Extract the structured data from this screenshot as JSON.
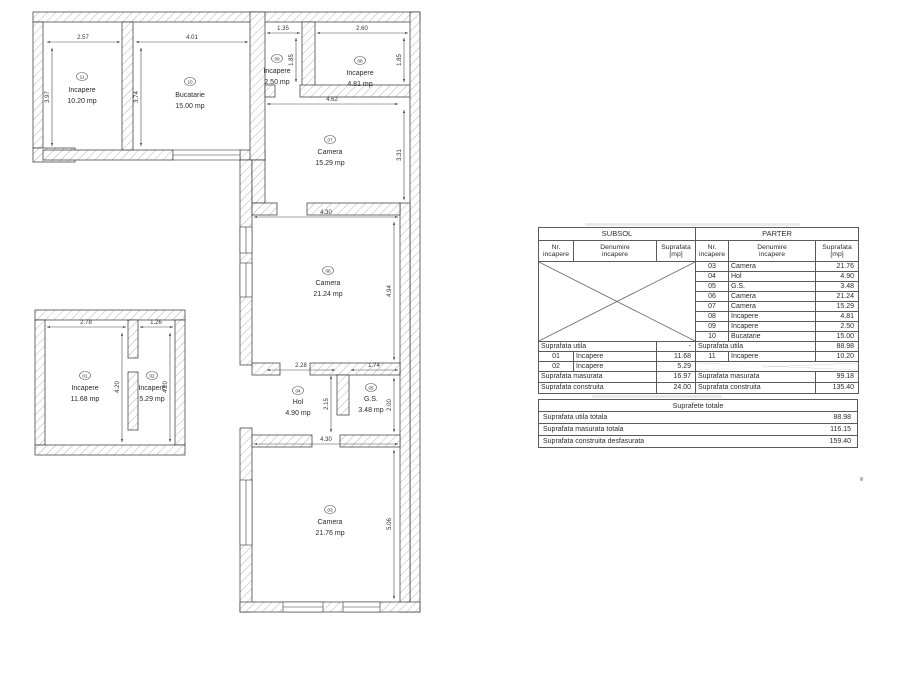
{
  "parter": {
    "rooms": [
      {
        "num": "11",
        "name": "Incapere",
        "area": "10.20 mp"
      },
      {
        "num": "10",
        "name": "Bucatarie",
        "area": "15.00 mp"
      },
      {
        "num": "09",
        "name": "Incapere",
        "area": "2.50 mp"
      },
      {
        "num": "08",
        "name": "Incapere",
        "area": "4.81 mp"
      },
      {
        "num": "07",
        "name": "Camera",
        "area": "15.29 mp"
      },
      {
        "num": "06",
        "name": "Camera",
        "area": "21.24 mp"
      },
      {
        "num": "04",
        "name": "Hol",
        "area": "4.90 mp"
      },
      {
        "num": "05",
        "name": "G.S.",
        "area": "3.48 mp"
      },
      {
        "num": "03",
        "name": "Camera",
        "area": "21.76 mp"
      }
    ],
    "dims": {
      "r11w": "2.57",
      "r11h": "3.97",
      "r10w": "4.01",
      "r10h": "3.74",
      "r09w": "1.35",
      "r09h": "1.85",
      "r08w": "2.60",
      "r08h": "1.85",
      "r07w": "4.62",
      "r07h": "3.31",
      "r06w": "4.30",
      "r06h": "4.94",
      "r04w": "2.28",
      "r04h": "2.15",
      "r05w": "1.74",
      "r05h": "2.00",
      "r03w": "4.30",
      "r03h": "5.06"
    }
  },
  "subsol": {
    "rooms": [
      {
        "num": "01",
        "name": "Incapere",
        "area": "11.68 mp"
      },
      {
        "num": "02",
        "name": "Incapere",
        "area": "5.29 mp"
      }
    ],
    "dims": {
      "r01w": "2.78",
      "r01h": "4.20",
      "r02w": "1.26",
      "r02h": "4.20"
    }
  },
  "tables": {
    "cols": {
      "nr_l1": "Nr.",
      "nr_l2": "incapere",
      "den_l1": "Denumire",
      "den_l2": "incapere",
      "sup_l1": "Suprafata",
      "sup_l2": "[mp]"
    },
    "subsol": {
      "title": "SUBSOL",
      "utila_label": "Suprafata utila",
      "utila_value": "-",
      "rows": [
        {
          "nr": "01",
          "name": "Incapere",
          "area": "11.68"
        },
        {
          "nr": "02",
          "name": "Incapere",
          "area": "5.29"
        }
      ],
      "masurata_label": "Suprafata masurata",
      "masurata_value": "16.97",
      "construita_label": "Suprafata construita",
      "construita_value": "24.00"
    },
    "parter": {
      "title": "PARTER",
      "rows": [
        {
          "nr": "03",
          "name": "Camera",
          "area": "21.76"
        },
        {
          "nr": "04",
          "name": "Hol",
          "area": "4.90"
        },
        {
          "nr": "05",
          "name": "G.S.",
          "area": "3.48"
        },
        {
          "nr": "06",
          "name": "Camera",
          "area": "21.24"
        },
        {
          "nr": "07",
          "name": "Camera",
          "area": "15.29"
        },
        {
          "nr": "08",
          "name": "Incapere",
          "area": "4.81"
        },
        {
          "nr": "09",
          "name": "Incapere",
          "area": "2.50"
        },
        {
          "nr": "10",
          "name": "Bucatarie",
          "area": "15.00"
        }
      ],
      "utila_label": "Suprafata utila",
      "utila_value": "88.98",
      "extra_row": {
        "nr": "11",
        "name": "Incapere",
        "area": "10.20"
      },
      "masurata_label": "Suprafata masurata",
      "masurata_value": "99.18",
      "construita_label": "Suprafata construita",
      "construita_value": "135.40"
    },
    "totals": {
      "title": "Suprafete totale",
      "rows": [
        {
          "label": "Suprafata utila totala",
          "value": "88.98"
        },
        {
          "label": "Suprafata masurata totala",
          "value": "116.15"
        },
        {
          "label": "Suprafata construita desfasurata",
          "value": "159.40"
        }
      ]
    }
  }
}
